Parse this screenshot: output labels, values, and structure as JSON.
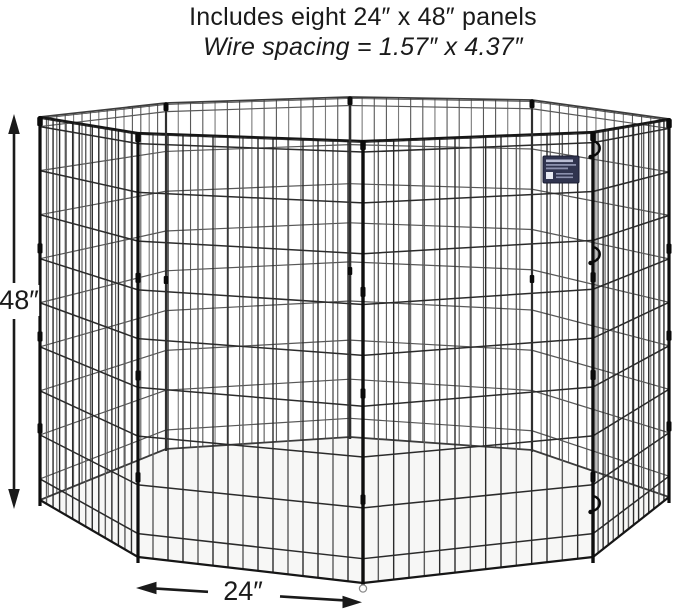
{
  "header": {
    "line1": "Includes eight 24″ x 48″ panels",
    "line2": "Wire spacing = 1.57″ x 4.37″"
  },
  "dimensions": {
    "height_label": "48″",
    "width_label": "24″"
  },
  "pen": {
    "panel_count": 8,
    "vertical_wires_per_panel": 14,
    "horizontal_wire_fractions": [
      0.025,
      0.14,
      0.255,
      0.37,
      0.485,
      0.6,
      0.715,
      0.83,
      0.945
    ],
    "has_product_tag": true
  },
  "colors": {
    "background": "#ffffff",
    "floor": "#f7f7f6",
    "wire_front_rail": "#161616",
    "wire_front": "#2b2b2b",
    "wire_front_sheen": "#5c5c5c",
    "wire_back_rail": "#3d3d3d",
    "wire_back": "#585858",
    "wire_back_sheen": "#7a7a7a",
    "post": "#0e0e0e",
    "clip": "#0a0a0a",
    "text": "#1a1a1a",
    "arrow": "#1a1a1a",
    "tag_bg": "#30344f",
    "tag_border": "#1b1e33",
    "tag_text_light": "#b9bdd4",
    "tag_text_dim": "#8b90ad",
    "tag_square": "#e8eaf2"
  }
}
